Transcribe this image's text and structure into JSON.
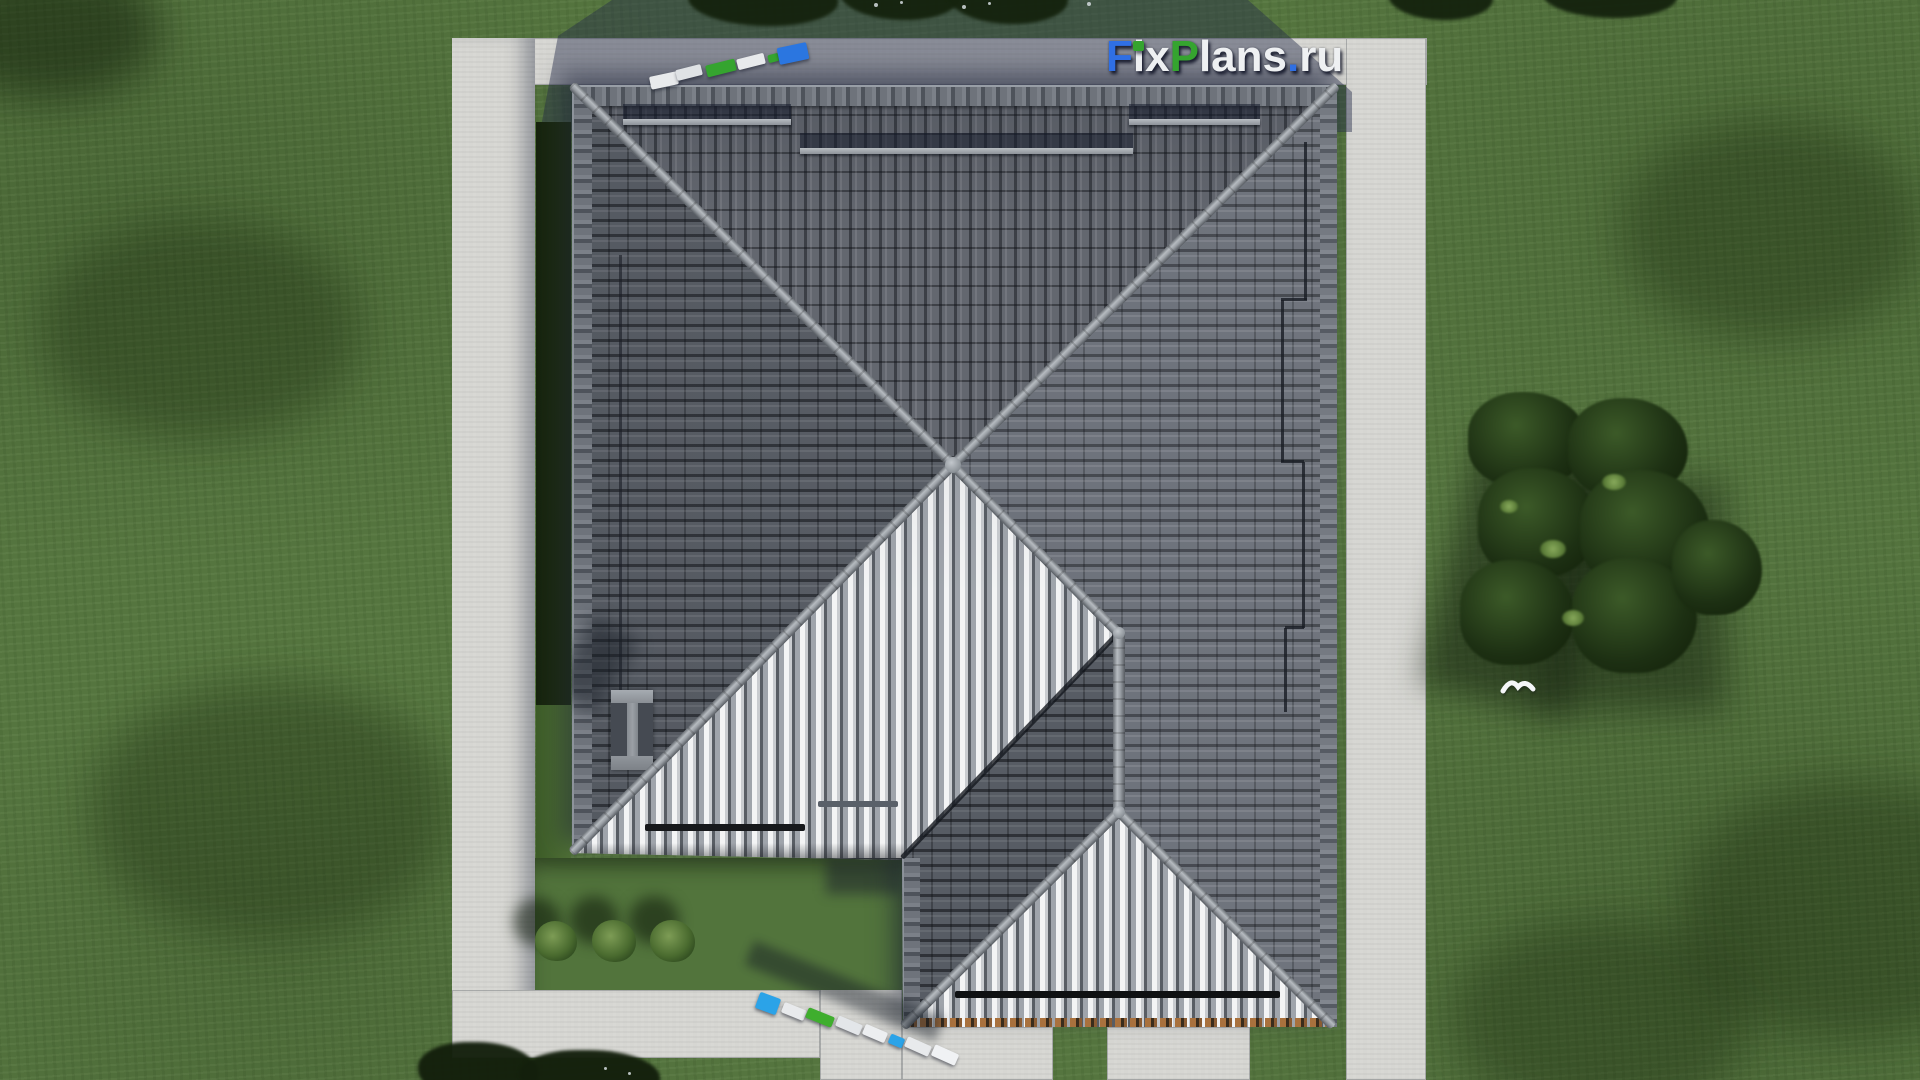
{
  "watermark": {
    "text": "FixPlans.ru",
    "segments": [
      {
        "text": "F",
        "color": "#2f6fe4"
      },
      {
        "text": "ix",
        "color": "#eef0f2"
      },
      {
        "text": "P",
        "color": "#35a42f"
      },
      {
        "text": "lans",
        "color": "#eef0f2"
      },
      {
        "text": ".",
        "color": "#2f6fe4"
      },
      {
        "text": "ru",
        "color": "#eef0f2"
      }
    ],
    "i_dot_color": "#35a42f"
  },
  "scene": {
    "type": "aerial-3d-render",
    "subject": "hip-roof house, top view",
    "elements": [
      "grass-lawn",
      "concrete-path-border",
      "hip-roof",
      "roof-wing-gable",
      "chimney",
      "snow-guard-bars",
      "lightning-conductor",
      "garden-bushes",
      "tree-cluster",
      "plank-piles",
      "bird"
    ],
    "counts": {
      "garden_bushes": 3,
      "plank_piles": 2,
      "snow_guard_bars": 3
    },
    "palette": {
      "grass": "#55753f",
      "grass_shadow": "#1d2f14",
      "concrete": "#d6d6d2",
      "concrete_shadow": "#8f95a8",
      "roof_dark_tile": "#63676f",
      "roof_light_tile": "#f3f4f5",
      "ridge_cap": "#9aa0a6",
      "batten_wood": "#a9713d",
      "plank_blue": "#2b76e0",
      "plank_cyan_blue": "#2ba3e8",
      "plank_green": "#3fae2e",
      "plank_white": "#e8eaec"
    }
  }
}
